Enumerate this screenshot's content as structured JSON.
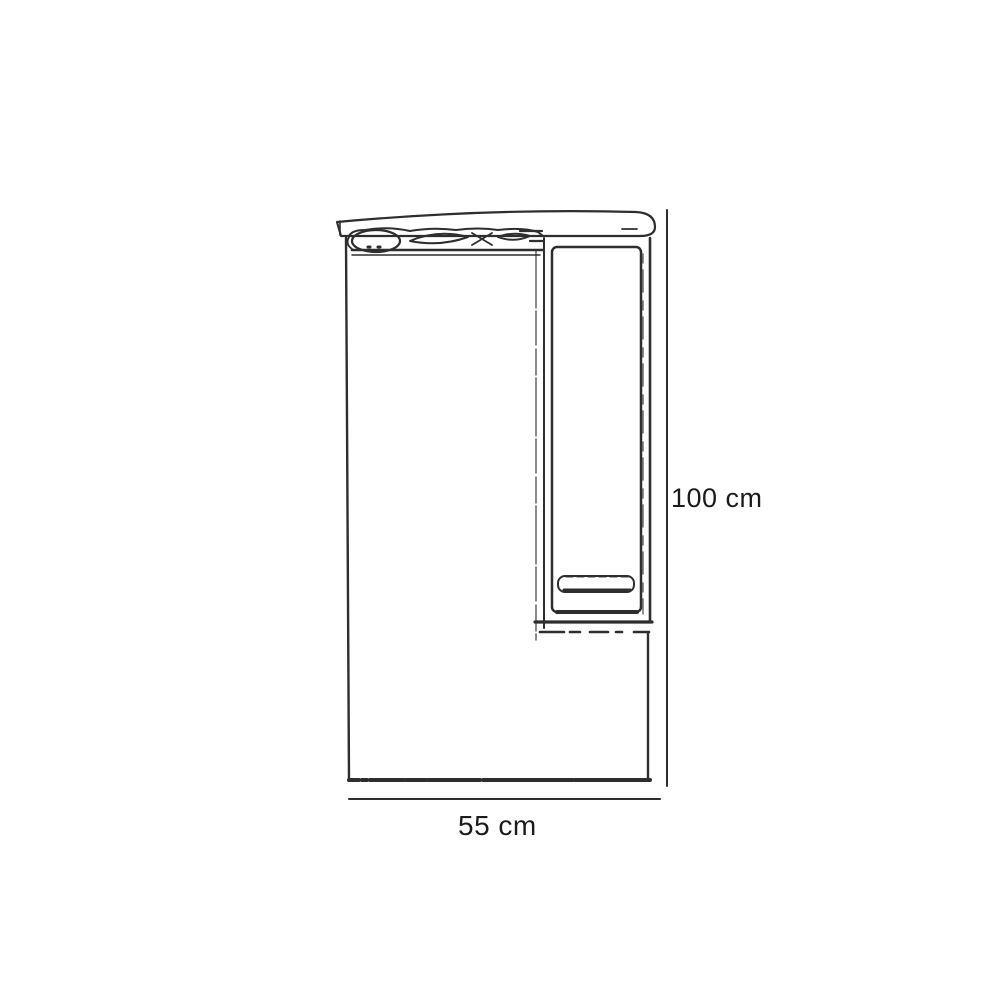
{
  "diagram": {
    "type": "product-dimension-drawing",
    "subject": "mirror-cabinet-with-canopy-light-and-side-door",
    "dimensions": {
      "height_label": "100 cm",
      "width_label": "55 cm",
      "height_value_cm": 100,
      "width_value_cm": 55,
      "unit": "cm"
    },
    "parts": [
      {
        "id": "canopy-top"
      },
      {
        "id": "light-fixture-strip"
      },
      {
        "id": "mirror-panel"
      },
      {
        "id": "side-cabinet"
      },
      {
        "id": "cabinet-door"
      },
      {
        "id": "door-handle"
      },
      {
        "id": "height-dimension-line"
      },
      {
        "id": "width-dimension-line"
      }
    ],
    "colors": {
      "background": "#ffffff",
      "line": "#2e2e2e",
      "line_strong": "#1d1d1d",
      "line_faint": "#5a5a5a",
      "dimension_line": "#b8b8b8",
      "label_text": "#1b1b1b"
    }
  }
}
